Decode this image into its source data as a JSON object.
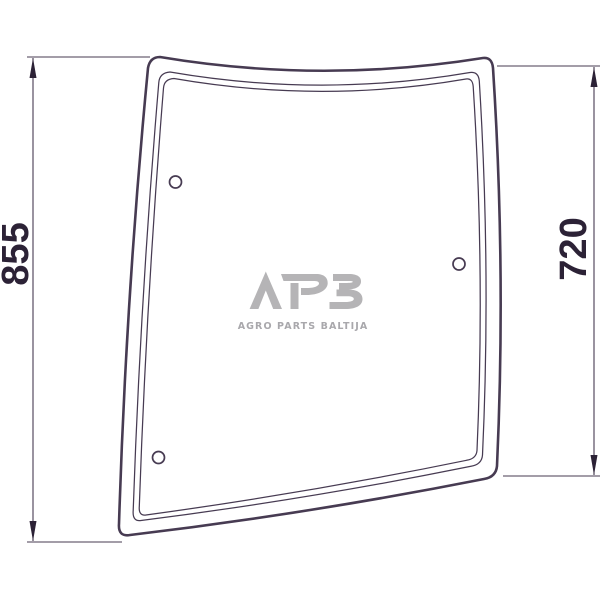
{
  "drawing": {
    "background_color": "#ffffff",
    "line_color": "#473b52",
    "dimension_color": "#2c2236",
    "dimensions": {
      "left_height": "855",
      "right_height": "720"
    },
    "holes_count": "3",
    "watermark": {
      "logo": "APB",
      "tagline": "AGRO PARTS BALTIJA",
      "color": "#b5b4b6",
      "tagline_color": "#a9a8ac"
    }
  }
}
